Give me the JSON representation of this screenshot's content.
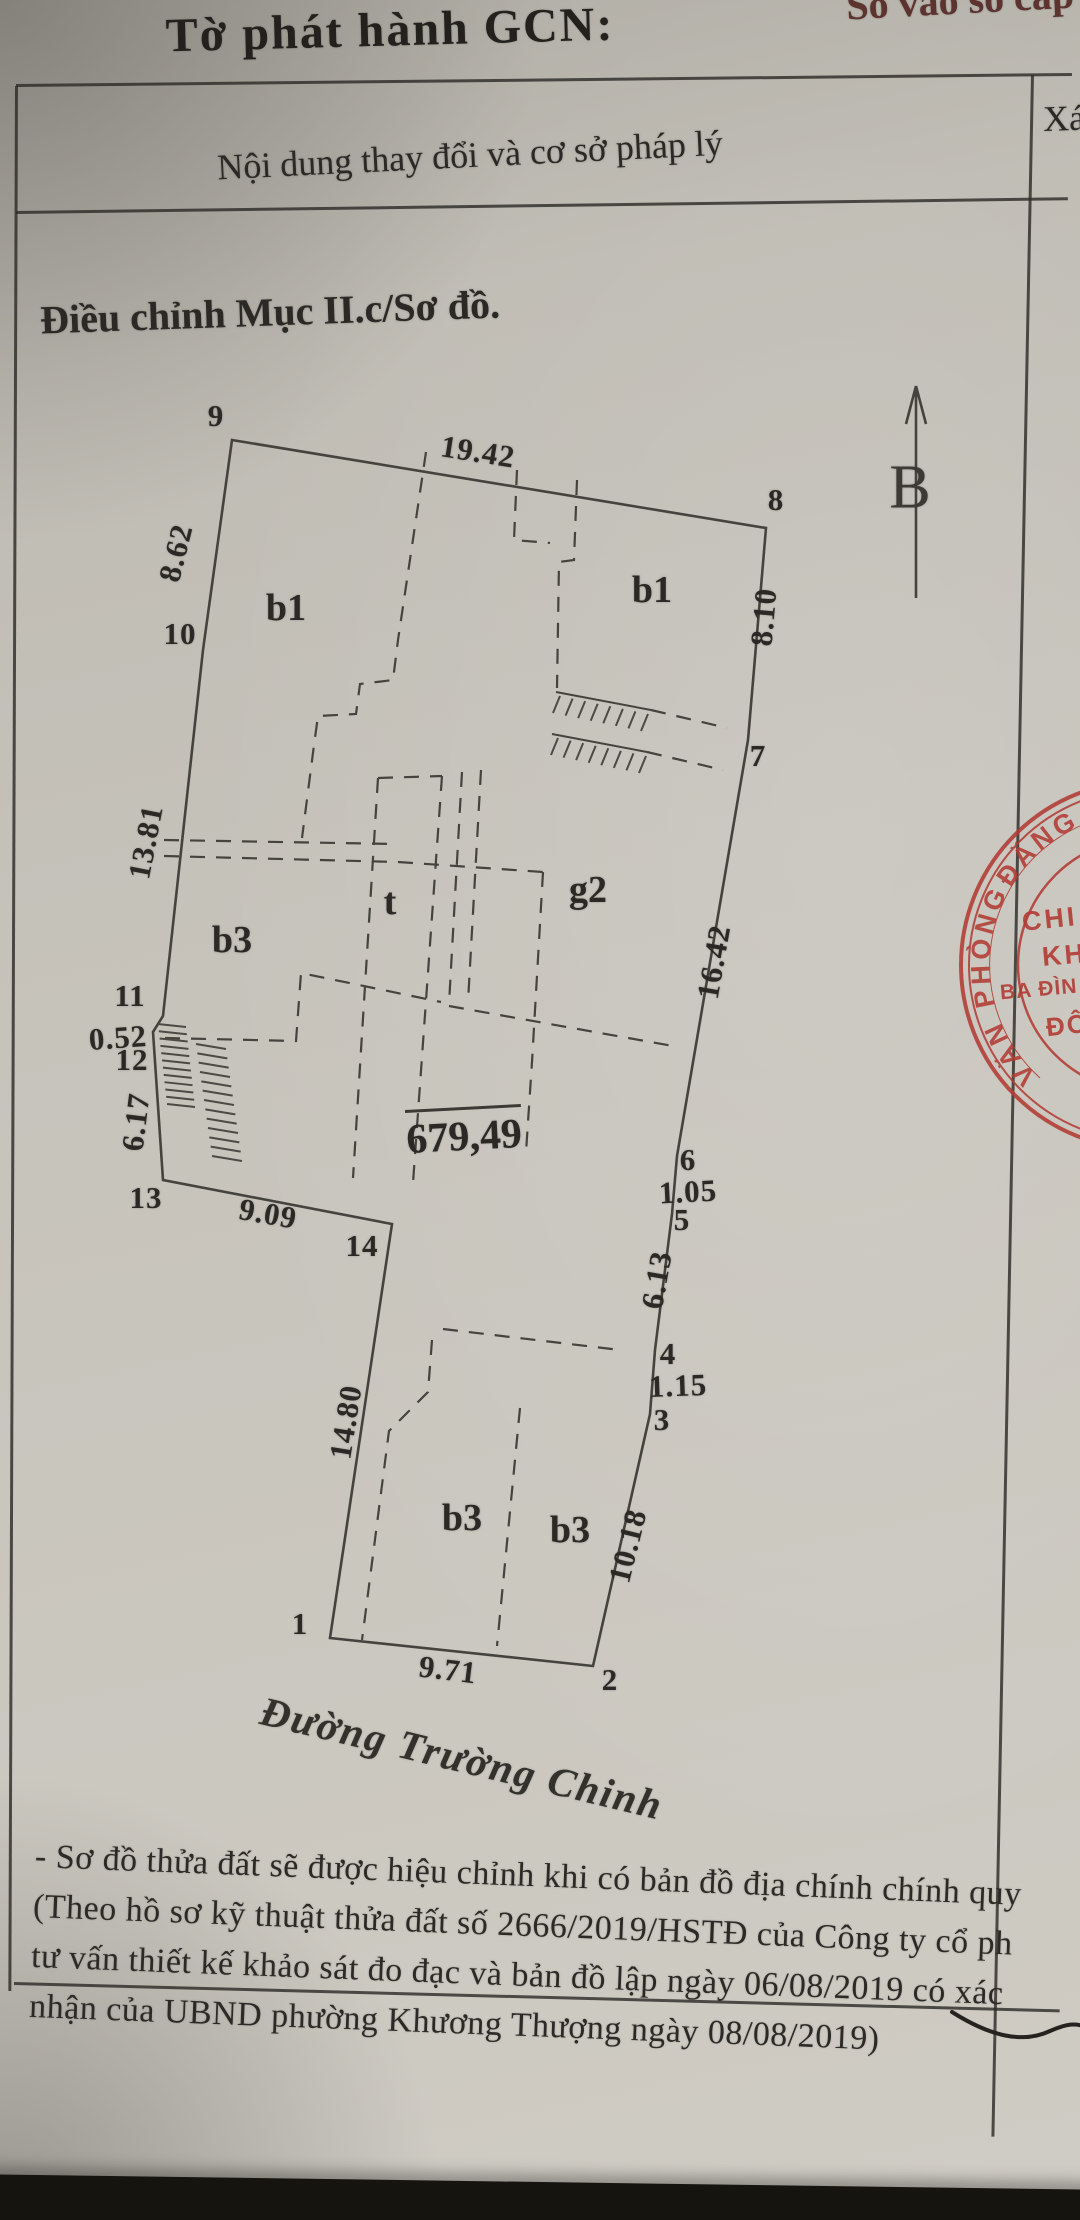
{
  "colors": {
    "paper": "#c6c3bb",
    "ink": "#262420",
    "diagram_line": "#45433e",
    "stamp_red": "#b23c35"
  },
  "header": {
    "title": "Tờ phát hành GCN:",
    "corner_note": "Sổ vào sổ cấp"
  },
  "table": {
    "left_header": "Nội dung thay đổi và cơ sở pháp lý",
    "right_header": "Xác"
  },
  "body": {
    "section_title": "Điều chỉnh Mục II.c/Sơ đồ."
  },
  "diagram": {
    "north_label": "B",
    "area_label": "679,49",
    "street_name": "Đường Trường Chinh",
    "vertex_labels": {
      "v1": "1",
      "v2": "2",
      "v3": "3",
      "v4": "4",
      "v5": "5",
      "v6": "6",
      "v7": "7",
      "v8": "8",
      "v9": "9",
      "v10": "10",
      "v11": "11",
      "v12": "12",
      "v13": "13",
      "v14": "14"
    },
    "edge_lengths": {
      "e9_8": "19.42",
      "e9_10": "8.62",
      "e10_11": "13.81",
      "e11_12": "0.52",
      "e12_13": "6.17",
      "e13_14": "9.09",
      "e14_1": "14.80",
      "e1_2": "9.71",
      "e2_3": "10.18",
      "e3_4": "1.15",
      "e4_5": "6.13",
      "e5_6": "1.05",
      "e6_7": "16.42",
      "e7_8": "8.10"
    },
    "region_labels": {
      "b1_left": "b1",
      "b1_right": "b1",
      "b3_mid": "b3",
      "t_room": "t",
      "g2": "g2",
      "b3_bottom_left": "b3",
      "b3_bottom_right": "b3"
    }
  },
  "stamp": {
    "arc_bottom": "VĂN",
    "arc_left": "PHÒNG",
    "arc_top": "ĐĂNG",
    "inner_line1": "CHI",
    "inner_line2": "KH",
    "inner_line3": "BA ĐÌN",
    "inner_line4": "ĐÔ"
  },
  "footnote": {
    "line1": "- Sơ đồ thửa đất sẽ được hiệu chỉnh khi có bản đồ địa chính chính quy",
    "line2": "(Theo hồ sơ kỹ thuật thửa đất số 2666/2019/HSTĐ của Công ty cổ ph",
    "line3": "tư vấn thiết kế khảo sát đo đạc và bản đồ lập ngày 06/08/2019 có xác",
    "line4": "nhận của UBND phường Khương Thượng ngày 08/08/2019)"
  }
}
